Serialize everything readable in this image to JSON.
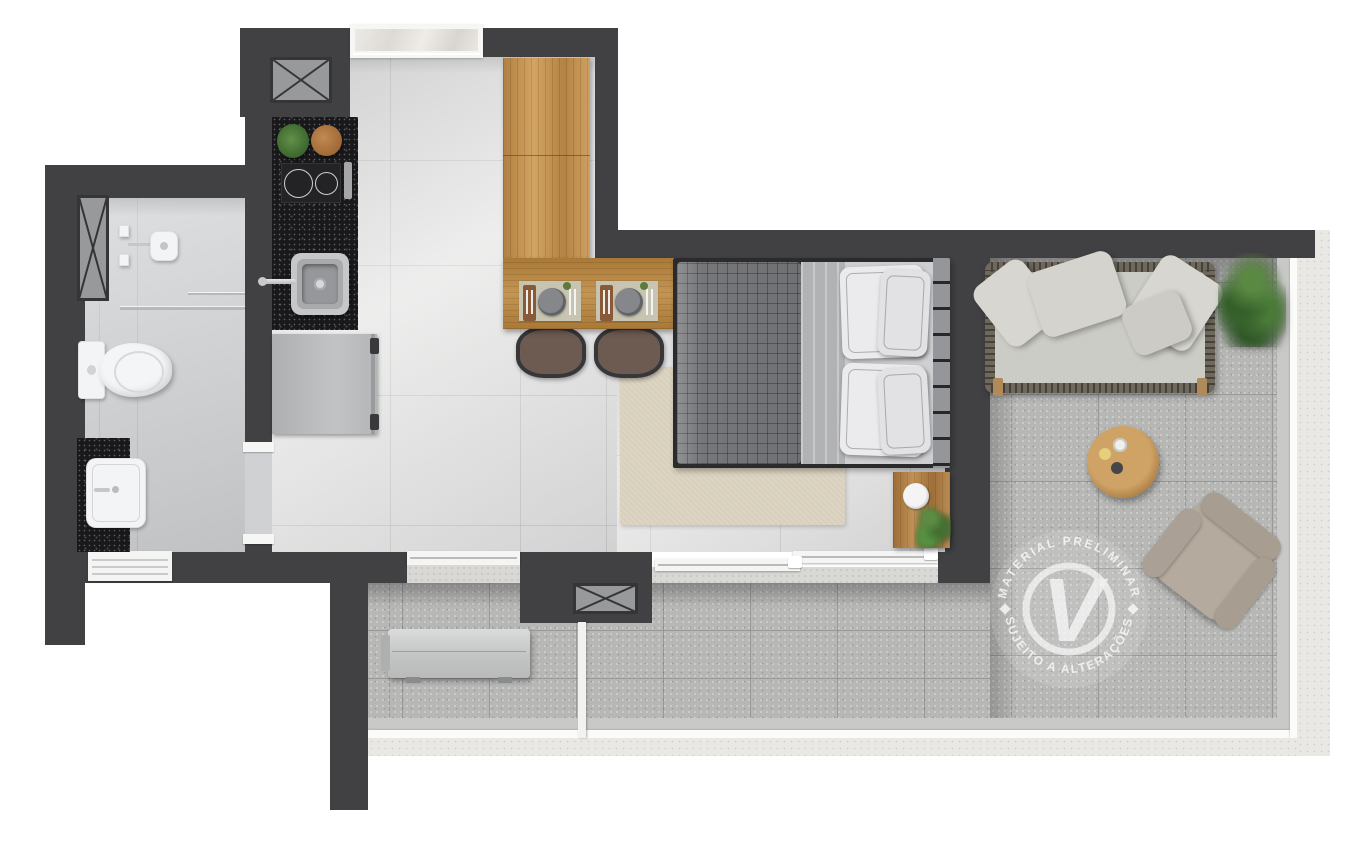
{
  "watermark": {
    "arc_top": "MATERIAL PRELIMINAR",
    "arc_bottom": "SUJEITO A ALTERAÇÕES",
    "monogram": "V"
  },
  "plan": {
    "title": "studio-apartment-floor-plan-top-down-render",
    "rooms": [
      {
        "name": "bathroom",
        "features": [
          "shower",
          "shower-head",
          "glass-partition",
          "toilet",
          "vanity-sink",
          "louver-window",
          "duct-shaft"
        ]
      },
      {
        "name": "kitchen",
        "features": [
          "granite-countertop",
          "two-burner-cooktop",
          "kitchen-sink",
          "faucet",
          "refrigerator",
          "window",
          "duct-shaft",
          "herb-plant",
          "cutting-board"
        ]
      },
      {
        "name": "living-bedroom",
        "features": [
          "wardrobe",
          "dining-table-for-two",
          "place-settings",
          "dining-chairs",
          "double-bed",
          "quilt",
          "pillows",
          "headboard",
          "nightstand",
          "area-rug",
          "sliding-doors"
        ]
      },
      {
        "name": "terrace",
        "features": [
          "outdoor-sofa",
          "throw-pillows",
          "round-coffee-table",
          "lounge-chair",
          "potted-plant",
          "ac-condenser",
          "glass-partition",
          "duct-shaft",
          "parapet-railing"
        ]
      }
    ]
  },
  "colors": {
    "wall": "#414143",
    "interior_floor": "#dcdcdb",
    "bathroom_floor": "#ccced0",
    "terrace_floor": "#b7b7b6",
    "counter_granite": "#19191b",
    "wood_light": "#c3914f",
    "wood_medium": "#a8783f",
    "bed_quilt": "#7d7e81",
    "pillow_white": "#ebebed",
    "sofa_cushion": "#ccccc6",
    "rug": "#d8d0bc",
    "plant_green": "#4a7a38",
    "railing_white": "#fbfbfa",
    "watermark_white": "#ffffff"
  }
}
